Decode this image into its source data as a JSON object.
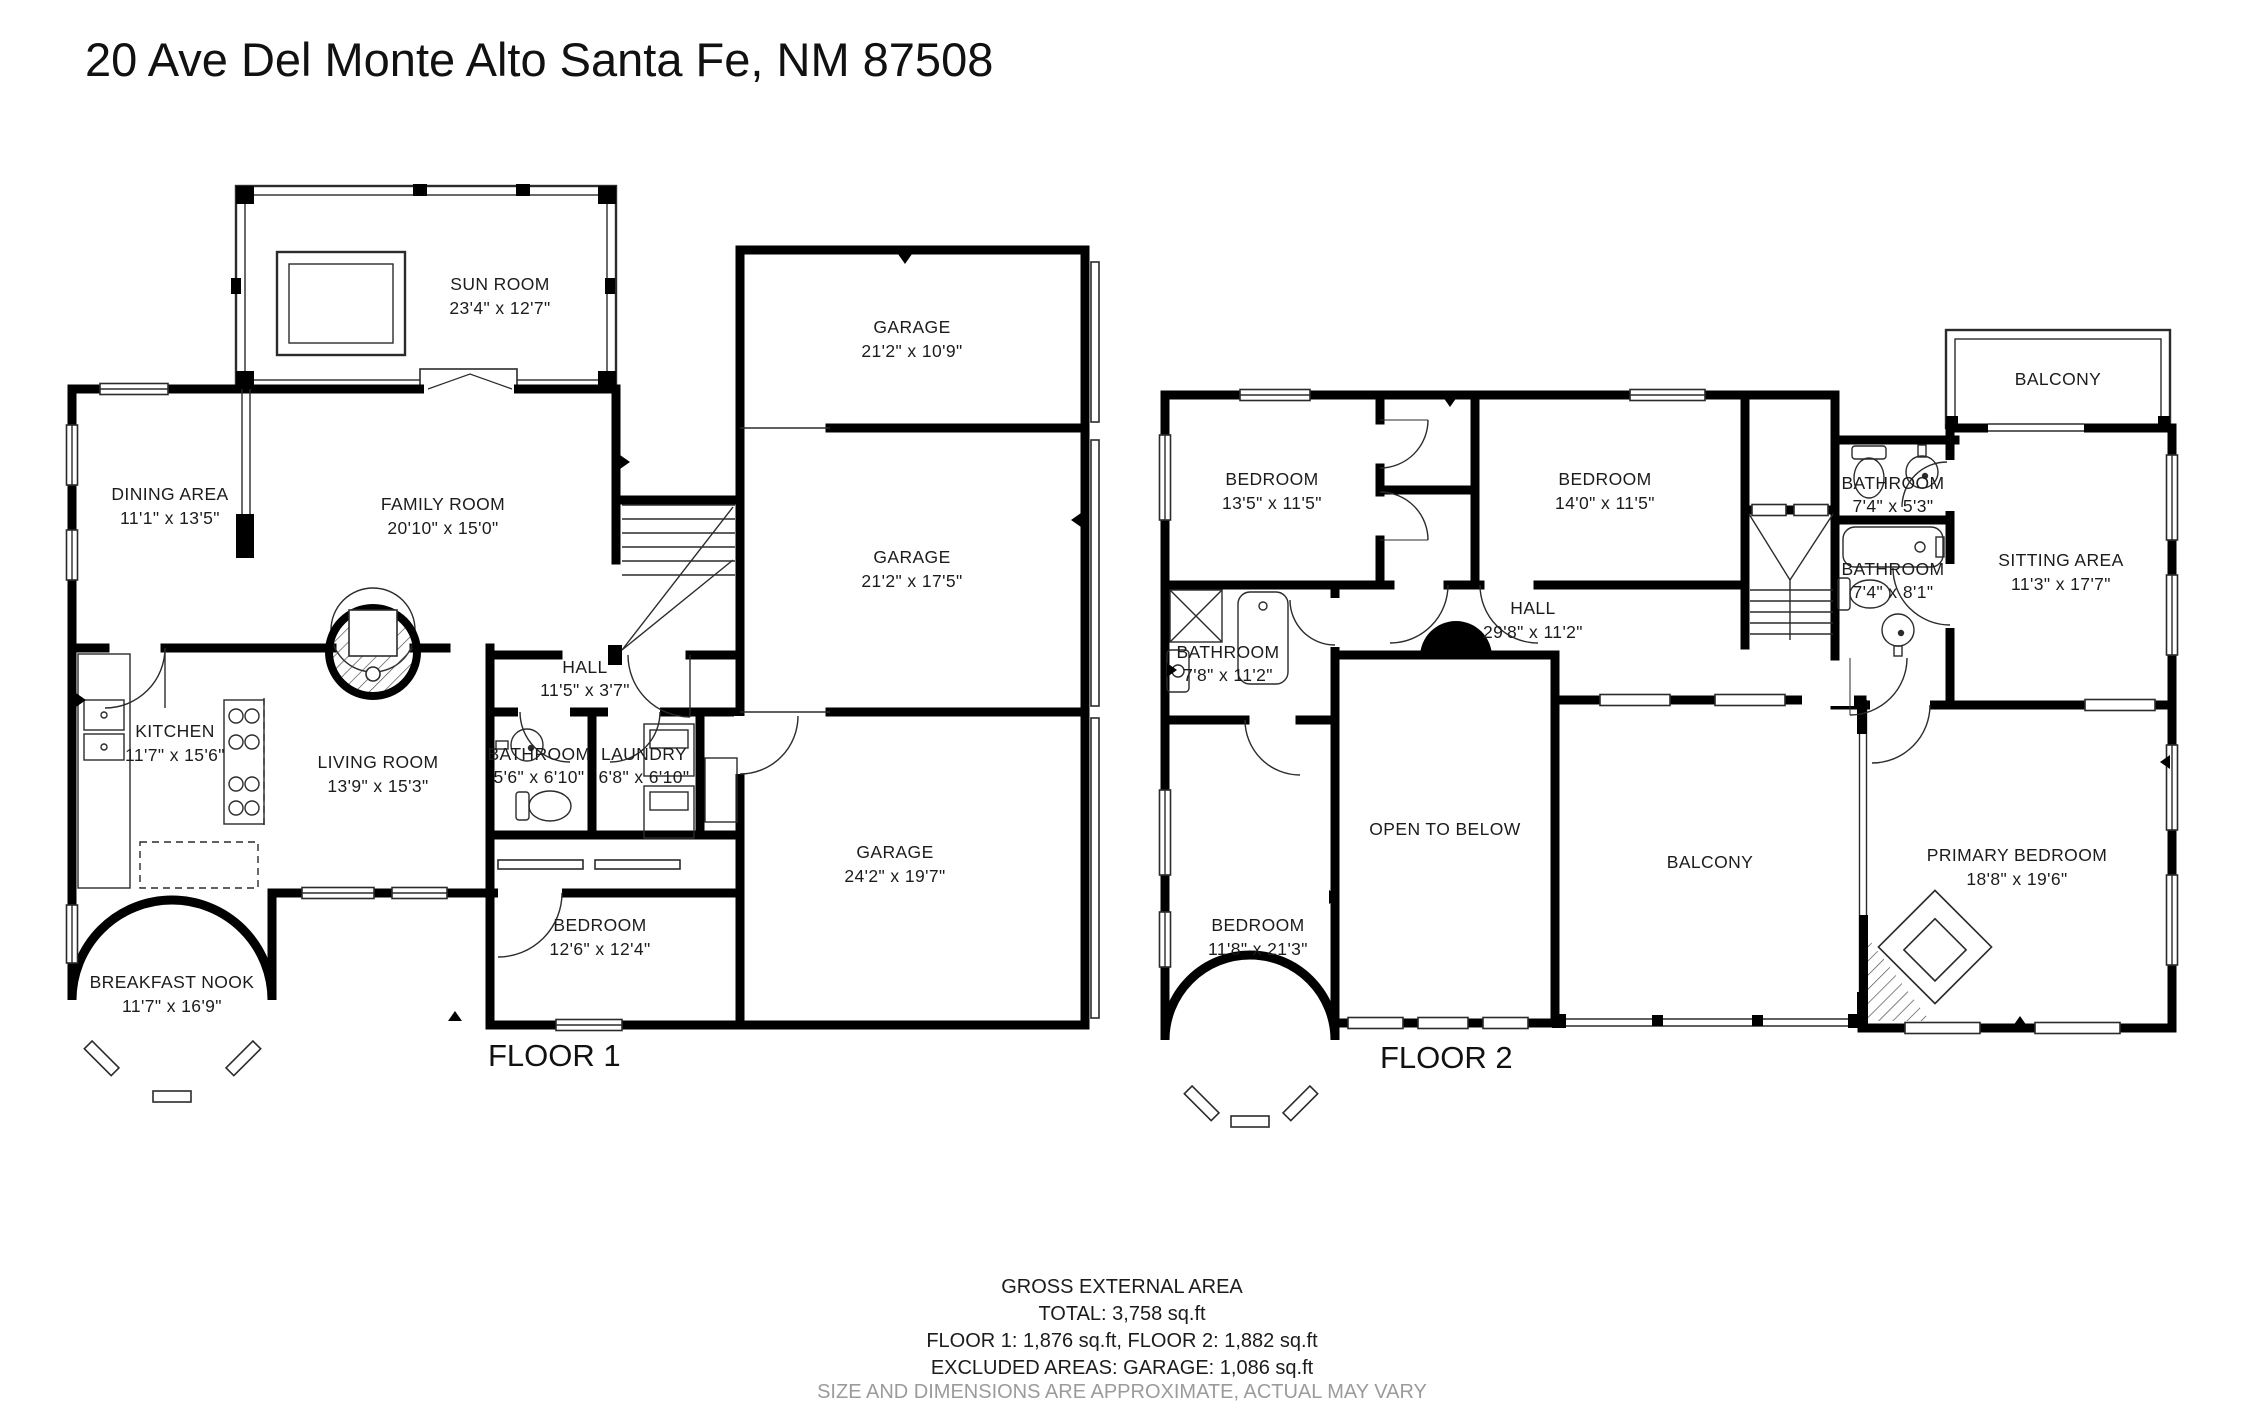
{
  "title": "20 Ave Del Monte Alto Santa Fe, NM 87508",
  "colors": {
    "wall": "#000000",
    "line": "#2b2b2b",
    "text": "#1c1c1c",
    "disclaimer": "#9b9b9b"
  },
  "floor1": {
    "label": "FLOOR 1",
    "rooms": {
      "sun_room": {
        "name": "SUN ROOM",
        "dims": "23'4\" x 12'7\""
      },
      "garage_top": {
        "name": "GARAGE",
        "dims": "21'2\" x 10'9\""
      },
      "dining": {
        "name": "DINING AREA",
        "dims": "11'1\" x 13'5\""
      },
      "family": {
        "name": "FAMILY ROOM",
        "dims": "20'10\" x 15'0\""
      },
      "garage_mid": {
        "name": "GARAGE",
        "dims": "21'2\" x 17'5\""
      },
      "hall": {
        "name": "HALL",
        "dims": "11'5\" x 3'7\""
      },
      "kitchen": {
        "name": "KITCHEN",
        "dims": "11'7\" x 15'6\""
      },
      "living": {
        "name": "LIVING ROOM",
        "dims": "13'9\" x 15'3\""
      },
      "bathroom": {
        "name": "BATHROOM",
        "dims": "5'6\" x 6'10\""
      },
      "laundry": {
        "name": "LAUNDRY",
        "dims": "6'8\" x 6'10\""
      },
      "garage_bottom": {
        "name": "GARAGE",
        "dims": "24'2\" x 19'7\""
      },
      "bedroom": {
        "name": "BEDROOM",
        "dims": "12'6\" x 12'4\""
      },
      "breakfast_nook": {
        "name": "BREAKFAST NOOK",
        "dims": "11'7\" x 16'9\""
      }
    }
  },
  "floor2": {
    "label": "FLOOR 2",
    "rooms": {
      "bedroom_left": {
        "name": "BEDROOM",
        "dims": "13'5\" x 11'5\""
      },
      "bedroom_mid": {
        "name": "BEDROOM",
        "dims": "14'0\" x 11'5\""
      },
      "balcony_top": {
        "name": "BALCONY"
      },
      "bathroom_small": {
        "name": "BATHROOM",
        "dims": "7'4\" x 5'3\""
      },
      "bathroom_mid": {
        "name": "BATHROOM",
        "dims": "7'4\" x 8'1\""
      },
      "sitting": {
        "name": "SITTING AREA",
        "dims": "11'3\" x 17'7\""
      },
      "hall": {
        "name": "HALL",
        "dims": "29'8\" x 11'2\""
      },
      "bathroom_west": {
        "name": "BATHROOM",
        "dims": "7'8\" x 11'2\""
      },
      "open_below": {
        "name": "OPEN TO BELOW"
      },
      "balcony_mid": {
        "name": "BALCONY"
      },
      "primary": {
        "name": "PRIMARY BEDROOM",
        "dims": "18'8\" x 19'6\""
      },
      "bedroom_bottom": {
        "name": "BEDROOM",
        "dims": "11'8\" x 21'3\""
      }
    }
  },
  "footer": {
    "heading": "GROSS EXTERNAL AREA",
    "total": "TOTAL: 3,758 sq.ft",
    "floors": "FLOOR 1: 1,876 sq.ft, FLOOR 2: 1,882 sq.ft",
    "excluded": "EXCLUDED AREAS: GARAGE: 1,086 sq.ft",
    "disclaimer": "SIZE AND DIMENSIONS ARE APPROXIMATE, ACTUAL MAY VARY"
  }
}
